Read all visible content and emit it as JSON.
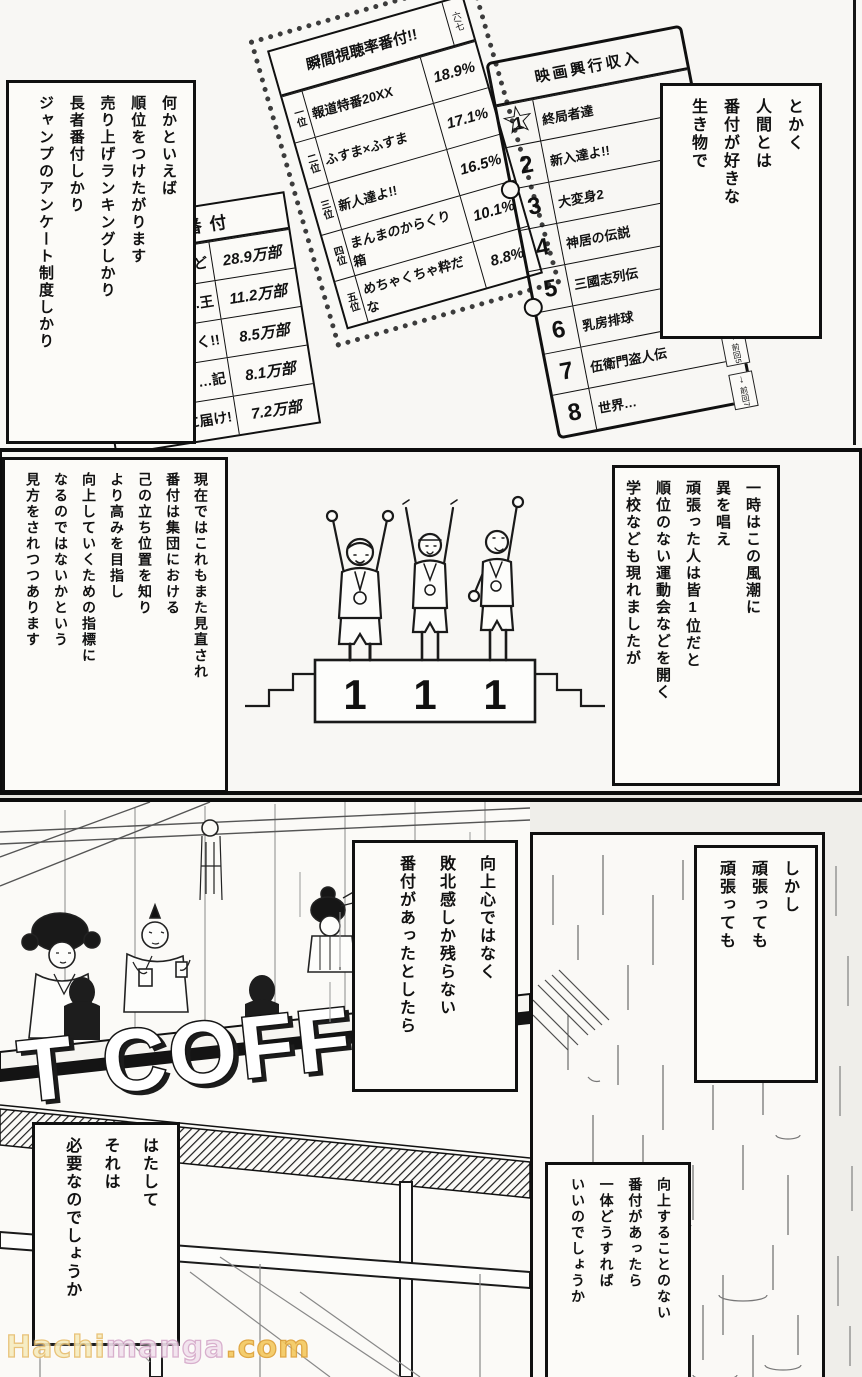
{
  "colors": {
    "paper": "#e7e5e0",
    "panel_white": "#f8f7f4",
    "ink": "#111111",
    "watermark_yellow": "#e7bd6d",
    "watermark_pink": "#d5a8c9",
    "watermark_orange": "#dd9f33"
  },
  "icons": {
    "star": "☆",
    "down_arrow": "↓"
  },
  "top": {
    "left_bubble": {
      "lines": [
        "何かといえば",
        "順位をつけたがります",
        "売り上げランキングしかり",
        "長者番付しかり",
        "ジャンプのアンケート制度しかり"
      ],
      "furigana": [
        "何=なに",
        "順位=じゅんい",
        "売り上げ=う・あ",
        "長者番付=ちょうじゃばんづけ",
        "制度=せいど"
      ]
    },
    "right_bubble": {
      "lines": [
        "とかく",
        "人間とは",
        "番付が好きな",
        "生き物で"
      ],
      "furigana": [
        "人間=にんげん",
        "番付=ばんづけ",
        "好=す",
        "生き物=いきもの"
      ]
    },
    "tv_board": {
      "title": "瞬間視聴率番付!!",
      "corner_note": "六/七",
      "rows": [
        {
          "rank": "一位",
          "title": "報道特番20XX",
          "share": "18.9%"
        },
        {
          "rank": "二位",
          "title": "ふすま×ふすま",
          "share": "17.1%"
        },
        {
          "rank": "三位",
          "title": "新人達よ!!",
          "share": "16.5%"
        },
        {
          "rank": "四位",
          "title": "まんまのからくり箱",
          "share": "10.1%"
        },
        {
          "rank": "五位",
          "title": "めちゃくちゃ粋だな",
          "share": "8.8%"
        }
      ]
    },
    "sales_board": {
      "title": "売上番付",
      "rows": [
        {
          "rank": "",
          "title": "…ど",
          "value": "28.9万部"
        },
        {
          "rank": "",
          "title": "…王",
          "value": "11.2万部"
        },
        {
          "rank": "",
          "title": "…く!!",
          "value": "8.5万部"
        },
        {
          "rank": "四",
          "title": "…記",
          "value": "8.1万部"
        },
        {
          "rank": "五",
          "title": "貴方に届け!",
          "value": "7.2万部"
        }
      ]
    },
    "movie_board": {
      "title": "映画興行収入",
      "rows": [
        {
          "rank": "1",
          "title": "終局者達"
        },
        {
          "rank": "2",
          "title": "新入達よ!!"
        },
        {
          "rank": "3",
          "title": "大変身2"
        },
        {
          "rank": "4",
          "title": "神居の伝説"
        },
        {
          "rank": "5",
          "title": "三國志列伝"
        },
        {
          "rank": "6",
          "title": "乳房排球"
        },
        {
          "rank": "7",
          "title": "伍衛門盗人伝"
        },
        {
          "rank": "8",
          "title": "世界…"
        }
      ],
      "side_markers": [
        "前回3",
        "前回4",
        "前回5",
        "前回7"
      ]
    }
  },
  "middle": {
    "left_box": {
      "lines": [
        "現在ではこれもまた見直され",
        "番付は集団における",
        "己の立ち位置を知り",
        "より高みを目指し",
        "向上していくための指標に",
        "なるのではないかという",
        "見方をされつつあります"
      ],
      "furigana": [
        "現在=げんざい",
        "見直=みなお",
        "番付=ばんづけ",
        "集団=しゅうだん",
        "己=おのれ",
        "立=た",
        "位置=いち",
        "知=し",
        "高=たか",
        "目指=めざ",
        "向上=こうじょう",
        "指標=しひょう",
        "見方=みかた"
      ]
    },
    "right_box": {
      "lines": [
        "一時はこの風潮に",
        "異を唱え",
        "頑張った人は皆1位だと",
        "順位のない運動会などを開く",
        "学校なども現れましたが"
      ],
      "furigana": [
        "一時=いちじ",
        "風潮=ふうちょう",
        "異=い",
        "唱=とな",
        "頑張=がんば",
        "人=ひと",
        "皆=みな",
        "1位=い",
        "順位=じゅんい",
        "運動会=うんどうかい",
        "開=ひら",
        "学校=がっこう",
        "現=あらわ"
      ]
    },
    "podium": {
      "labels": [
        "1",
        "1",
        "1"
      ]
    }
  },
  "bottom": {
    "shikashi_box": {
      "lines": [
        "しかし",
        "頑張っても",
        "頑張っても"
      ],
      "furigana": [
        "頑張=がんば"
      ]
    },
    "kojoshin_box": {
      "lines": [
        "向上心ではなく",
        "敗北感しか残らない",
        "番付があったとしたら"
      ],
      "furigana": [
        "向上心=こうじょうしん",
        "敗北感=はいぼくかん",
        "残=のこ",
        "番付=ばんづけ"
      ]
    },
    "hatashite_box": {
      "lines": [
        "はたして",
        "それは",
        "必要なのでしょうか"
      ],
      "furigana": [
        "必要=ひつよう"
      ]
    },
    "kojo_box": {
      "lines": [
        "向上することのない",
        "番付があったら",
        "一体どうすれば",
        "いいのでしょうか"
      ],
      "furigana": [
        "向上=こうじょう",
        "番付=ばんづけ",
        "一体=いったい"
      ]
    },
    "coffee_sign": {
      "text": "T COFFEE"
    }
  },
  "watermark": {
    "part1": "Hachi",
    "part2": "manga",
    "part3": ".com"
  }
}
